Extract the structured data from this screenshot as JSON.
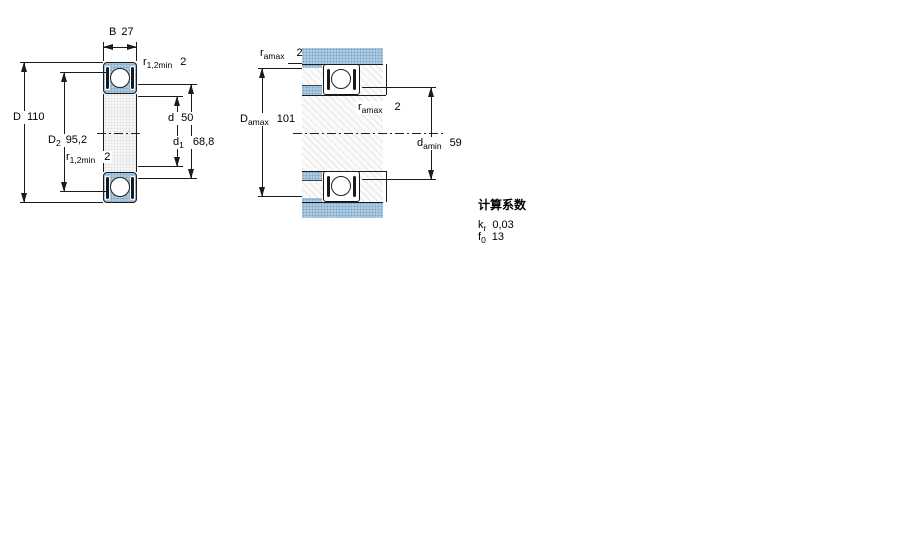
{
  "drawing": {
    "left_view": {
      "name": "bearing-cross-section",
      "dims": {
        "width": {
          "label": "B",
          "value": "27"
        },
        "outer_diameter": {
          "label": "D",
          "value": "110"
        },
        "recess_diameter": {
          "label": "D",
          "sub": "2",
          "value": "95,2"
        },
        "chamfer_top": {
          "label": "r",
          "sub": "1,2min",
          "value": "2"
        },
        "chamfer_bottom": {
          "label": "r",
          "sub": "1,2min",
          "value": "2"
        },
        "bore_diameter": {
          "label": "d",
          "value": "50"
        },
        "shoulder_diameter": {
          "label": "d",
          "sub": "1",
          "value": "68,8"
        }
      }
    },
    "right_view": {
      "name": "abutment-and-fillet-dimensions",
      "dims": {
        "fillet_housing": {
          "label": "r",
          "sub": "amax",
          "value": "2"
        },
        "housing_abutment": {
          "label": "D",
          "sub": "amax",
          "value": "101"
        },
        "fillet_shaft": {
          "label": "r",
          "sub": "amax",
          "value": "2"
        },
        "shaft_abutment": {
          "label": "d",
          "sub": "amin",
          "value": "59"
        }
      }
    }
  },
  "calculation_factors": {
    "title": "计算系数",
    "rows": [
      {
        "label": "k",
        "sub": "r",
        "value": "0,03"
      },
      {
        "label": "f",
        "sub": "0",
        "value": "13"
      }
    ]
  },
  "colors": {
    "ring_fill": "#aecbe2",
    "ring_dot": "#7ea9cb",
    "line": "#1b1b1b",
    "background": "#ffffff"
  }
}
